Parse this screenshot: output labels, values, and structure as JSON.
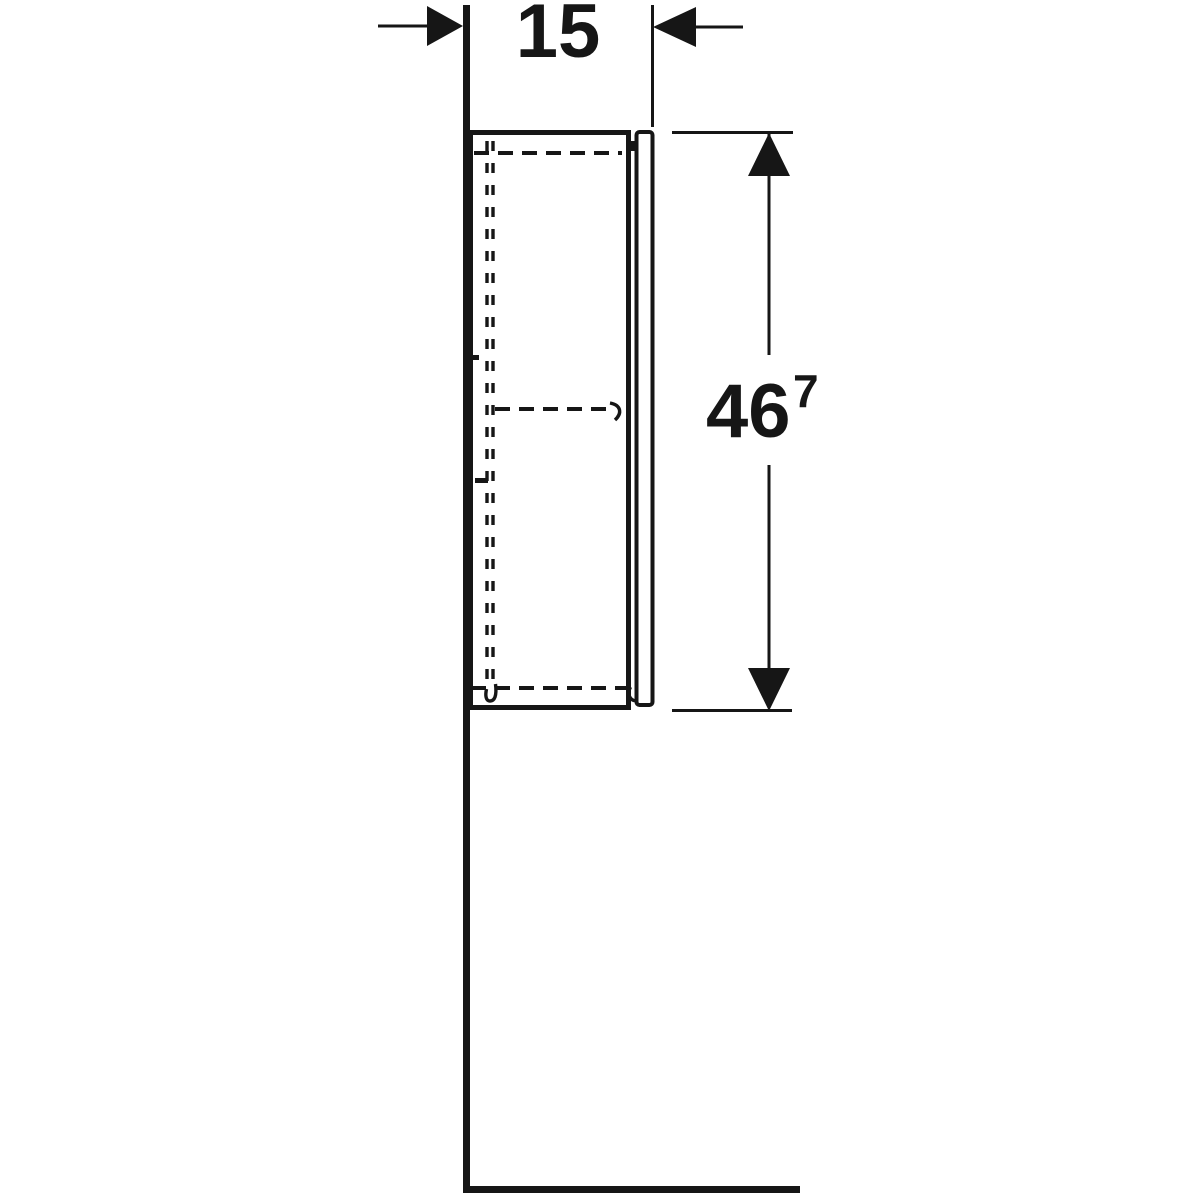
{
  "colors": {
    "ink": "#161616",
    "paper": "#ffffff"
  },
  "annotations": {
    "width_dim": {
      "value": "15"
    },
    "height_dim": {
      "value": "46",
      "superscript": "7"
    }
  }
}
